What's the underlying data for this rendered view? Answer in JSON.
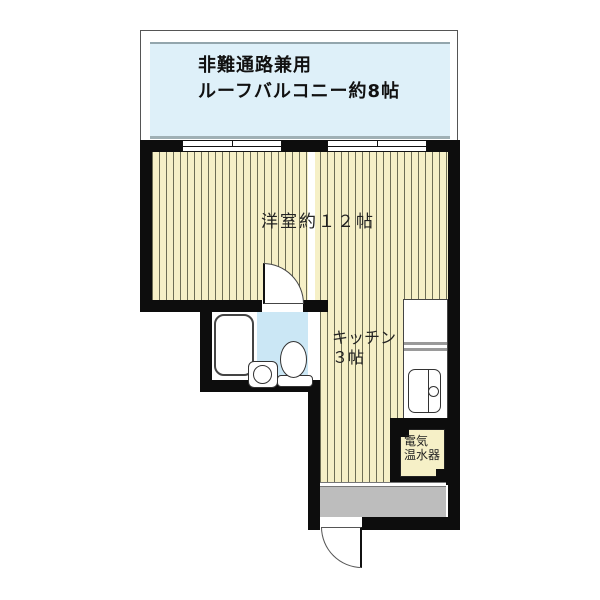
{
  "colors": {
    "wall": "#0d0d0d",
    "floor": "#f6f0c7",
    "stripe": "#6e6e55",
    "balcony": "#def0f9",
    "bath": "#cbe7f5",
    "entry": "#bdbdbd"
  },
  "balcony": {
    "line1": "非難通路兼用",
    "line2": "ルーフバルコニー約8帖"
  },
  "living_room": {
    "label": "洋室約１２帖"
  },
  "kitchen": {
    "line1": "キッチン",
    "line2": "３帖"
  },
  "water_heater": {
    "line1": "電気",
    "line2": "温水器"
  }
}
